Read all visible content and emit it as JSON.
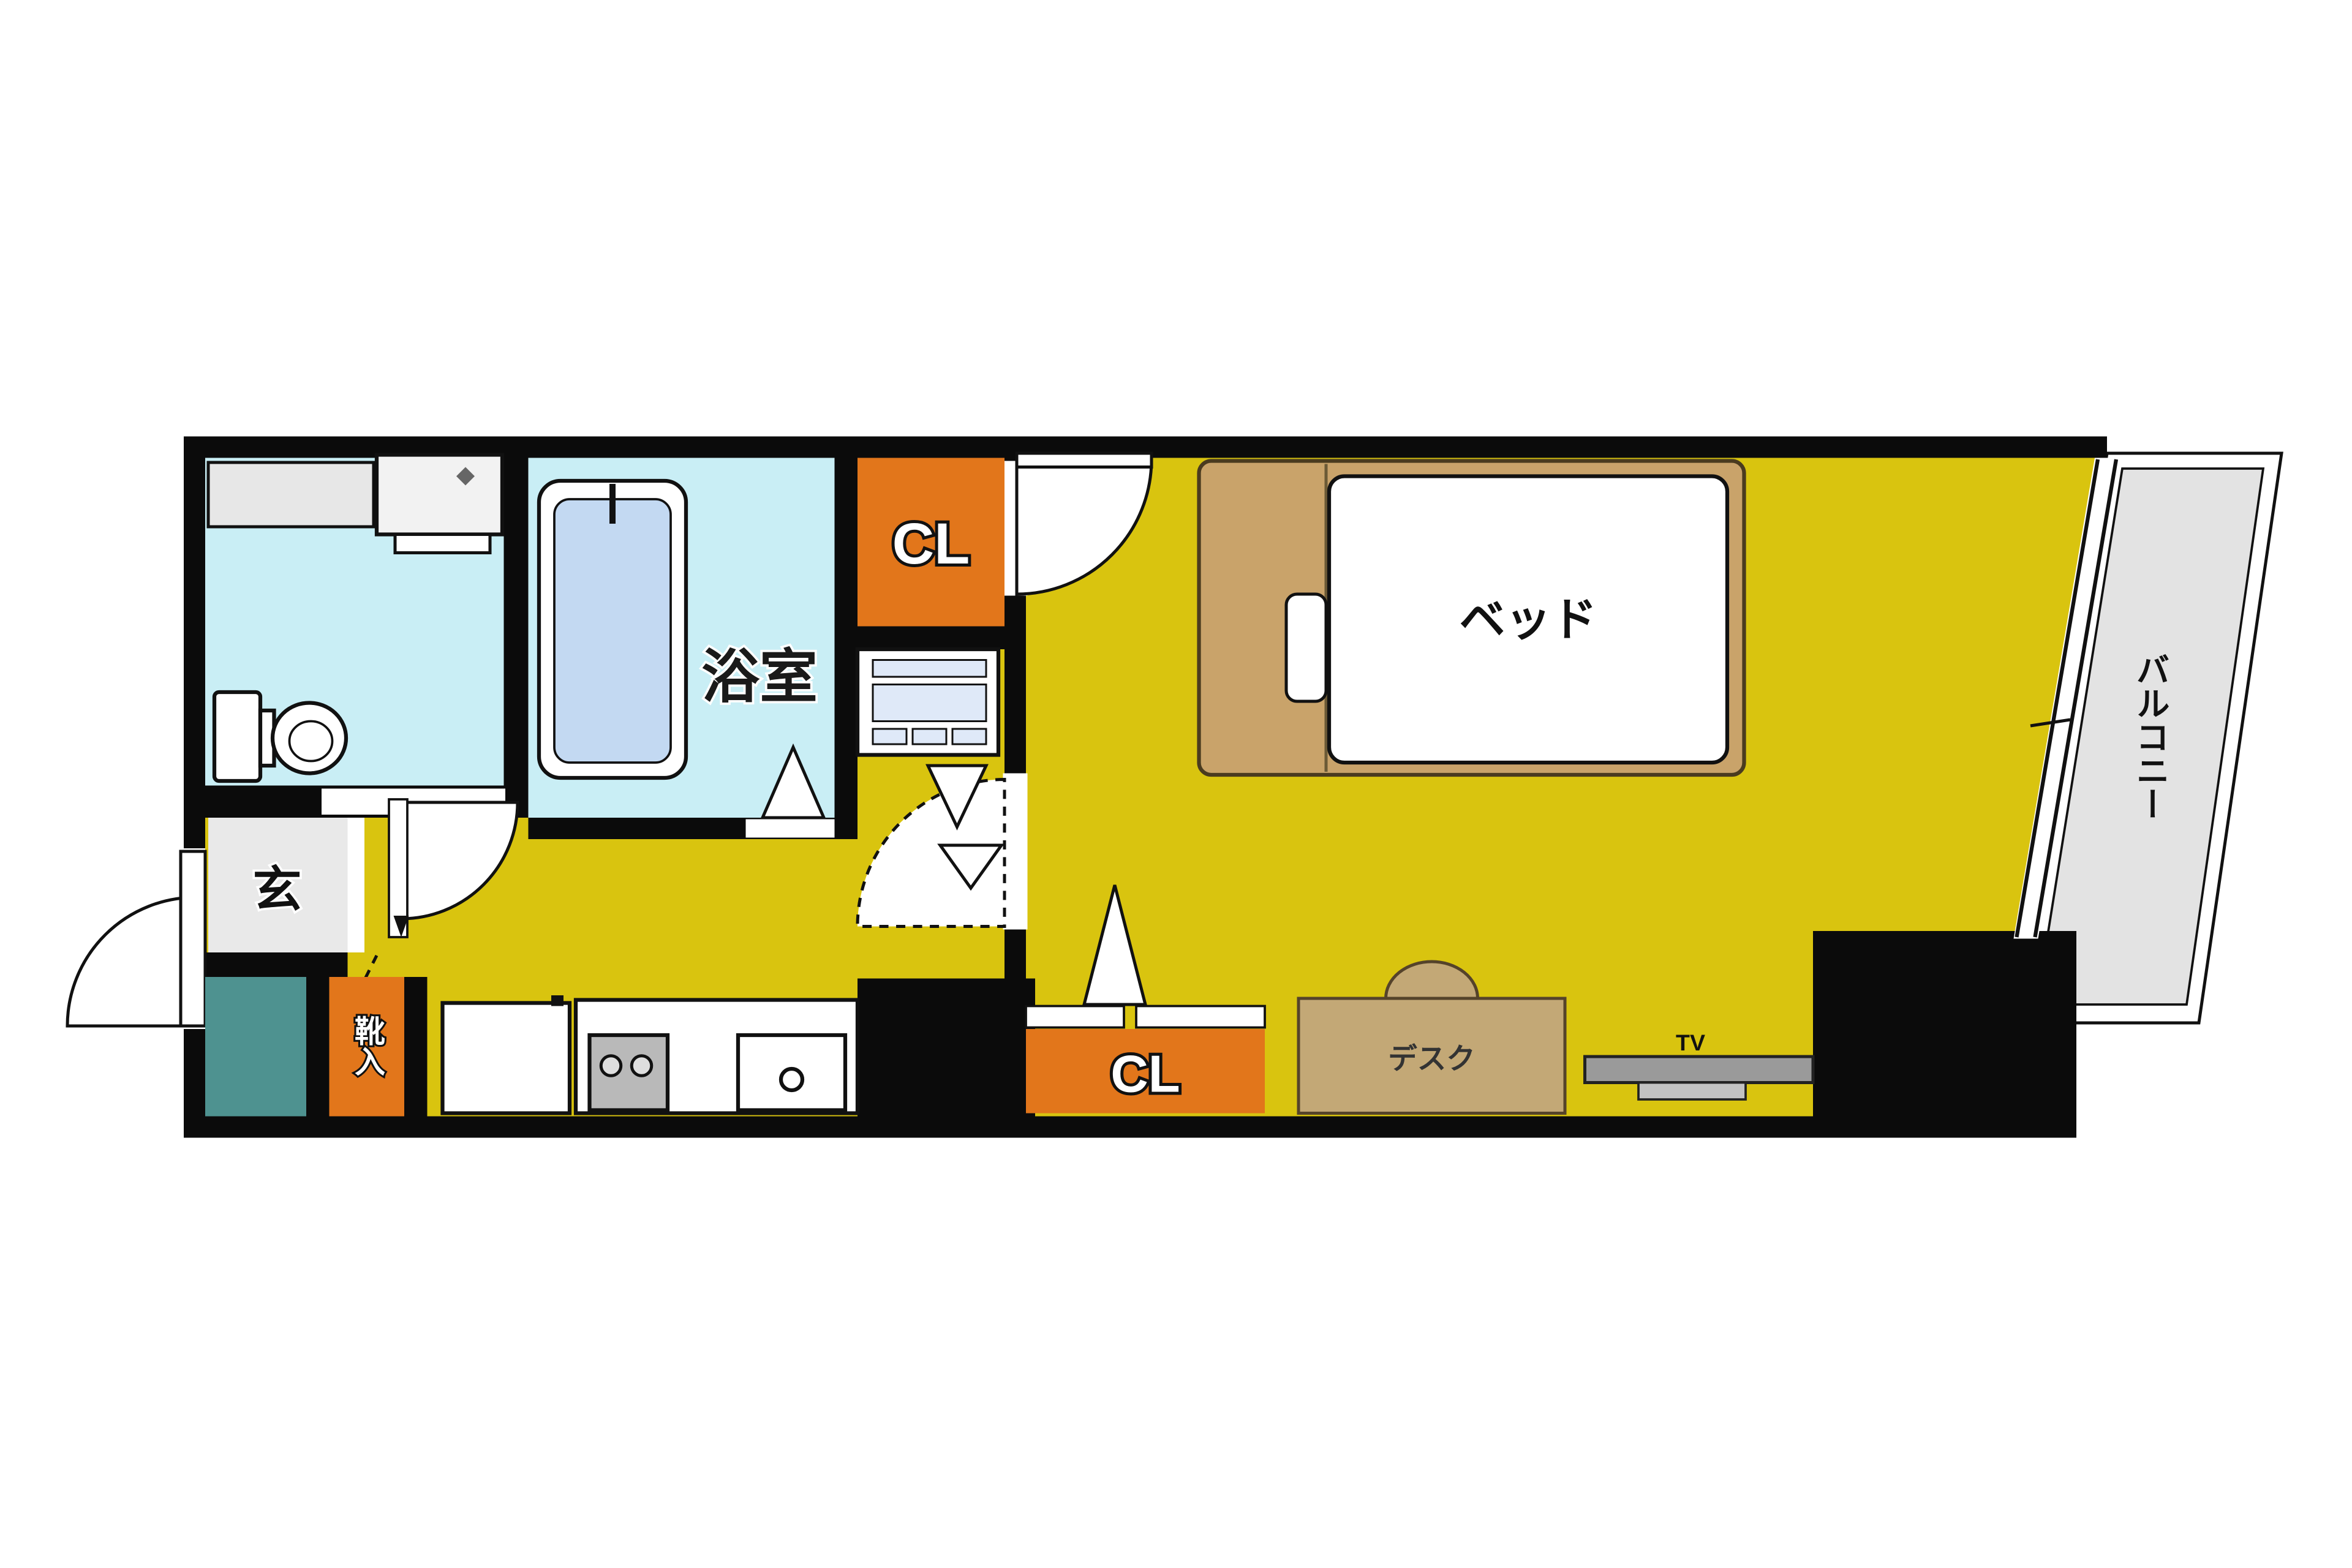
{
  "plan": {
    "title": "apartment-floor-plan",
    "rooms": {
      "bathroom_label": "浴室",
      "closet_top_label": "CL",
      "closet_bottom_label": "CL",
      "entrance_label": "玄",
      "shoe_cabinet_label": "靴入",
      "balcony_label": "バルコニー"
    },
    "furniture": {
      "bed_label": "ベッド",
      "desk_label": "デスク",
      "tv_label": "TV"
    },
    "colors": {
      "wall": "#0b0b0b",
      "floor": "#d9c40f",
      "wet_room": "#c9eef5",
      "tub_water": "#c3d9f2",
      "closet_orange": "#e2761b",
      "entrance_gray": "#e9e9e9",
      "counter_gray": "#e7e7e7",
      "teal_box": "#4e9290",
      "bed_frame": "#c9a36a",
      "desk_tan": "#c3a876",
      "balcony_gray": "#e3e3e3",
      "tv_gray": "#9a9a9a",
      "stove_gray": "#b9b9b9",
      "panel_blue": "#dfe9f8",
      "white": "#ffffff"
    }
  }
}
